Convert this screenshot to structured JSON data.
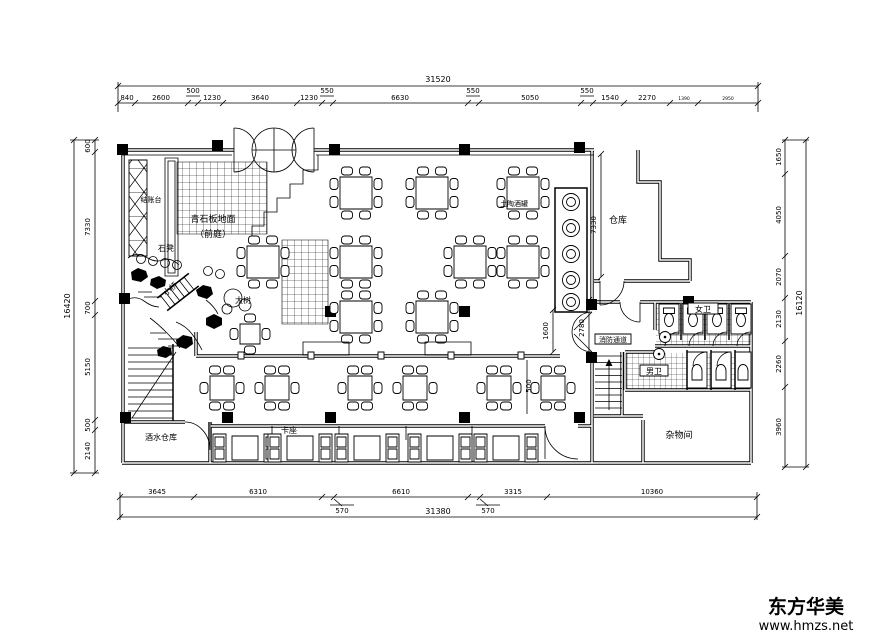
{
  "watermark": {
    "brand": "东方华美",
    "site": "www.hmzs.net"
  },
  "room_labels": {
    "cashier": "结账台",
    "stone_floor": "青石板地面",
    "front_yard": "（前庭）",
    "stone_bench": "石凳",
    "bridge": "小桥",
    "big_tree": "大树",
    "wine_jars": "土陶酒罐",
    "warehouse": "仓库",
    "fire_passage": "消防通道",
    "women_wc": "女卫",
    "men_wc": "男卫",
    "sundries_room": "杂物间",
    "drinks_warehouse": "酒水仓库",
    "booth_seating": "卡座"
  },
  "dimensions": {
    "top_total": "31520",
    "top_segments": [
      "840",
      "2600",
      "500",
      "1230",
      "3640",
      "1230",
      "550",
      "6630",
      "550",
      "5050",
      "550",
      "1540",
      "2270",
      "1390",
      "2950"
    ],
    "bottom_total": "31380",
    "bottom_segments": [
      "3645",
      "6310",
      "570",
      "6610",
      "570",
      "3315",
      "10360"
    ],
    "left_total": "16420",
    "left_segments": [
      "600",
      "7330",
      "700",
      "5150",
      "500",
      "2140"
    ],
    "right_total": "16120",
    "right_segments": [
      "1650",
      "4050",
      "2070",
      "2130",
      "2260",
      "3960"
    ],
    "interior": {
      "warehouse_depth": "7330",
      "fire_passage_width": "2780",
      "door_opening": "1600",
      "aisle": "500"
    }
  }
}
